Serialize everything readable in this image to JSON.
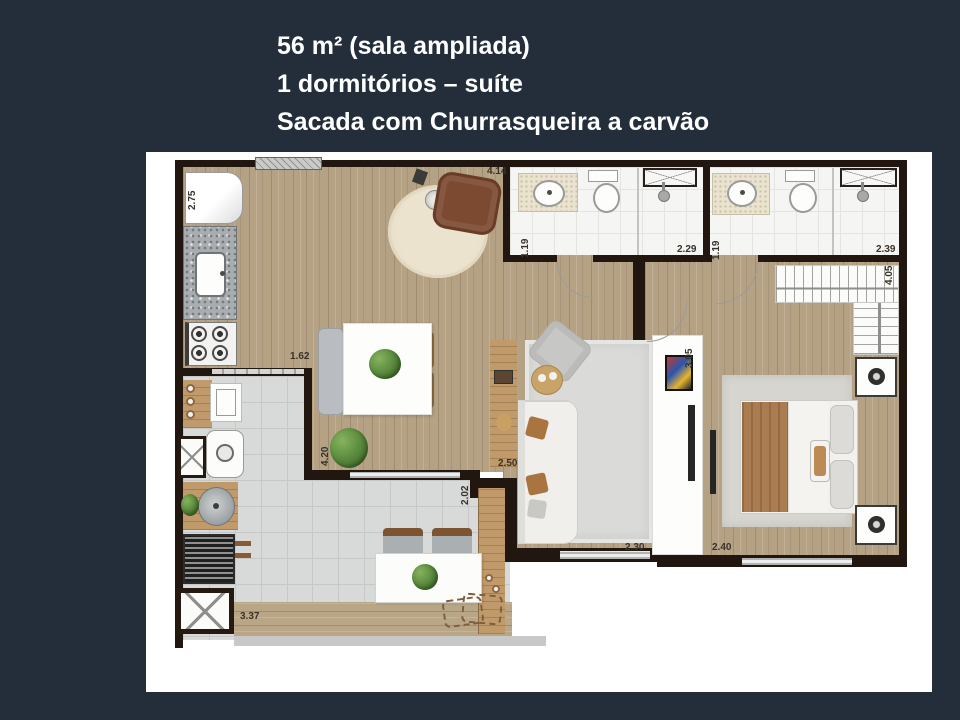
{
  "title": {
    "line1": "56 m² (sala ampliada)",
    "line2": "1 dormitórios – suíte",
    "line3": "Sacada com Churrasqueira a carvão"
  },
  "colors": {
    "background": "#242e3b",
    "card": "#ffffff",
    "wall": "#221710",
    "wood_floor": "#b5a285",
    "balcony_tile": "#d8dad9",
    "bath_tile": "#f5f5f3",
    "title_text": "#ffffff",
    "dimension_text": "#39322a"
  },
  "floorplan": {
    "dimensions": [
      {
        "id": "kitchen-depth",
        "label": "2.75",
        "orientation": "vertical"
      },
      {
        "id": "living-top",
        "label": "4.14",
        "orientation": "horizontal"
      },
      {
        "id": "bath1-depth",
        "label": "1.19",
        "orientation": "vertical"
      },
      {
        "id": "bath1-width",
        "label": "2.29",
        "orientation": "horizontal"
      },
      {
        "id": "bath2-depth",
        "label": "1.19",
        "orientation": "vertical"
      },
      {
        "id": "bath2-width",
        "label": "2.39",
        "orientation": "horizontal"
      },
      {
        "id": "bedroom-depth",
        "label": "4.05",
        "orientation": "vertical"
      },
      {
        "id": "living-depth",
        "label": "3.05",
        "orientation": "vertical"
      },
      {
        "id": "kitchen-opening",
        "label": "1.62",
        "orientation": "horizontal"
      },
      {
        "id": "balcony-depth",
        "label": "4.20",
        "orientation": "vertical"
      },
      {
        "id": "living-width",
        "label": "2.50",
        "orientation": "horizontal"
      },
      {
        "id": "balcony-pass",
        "label": "2.02",
        "orientation": "vertical"
      },
      {
        "id": "living-window",
        "label": "2.30",
        "orientation": "horizontal"
      },
      {
        "id": "bedroom-width",
        "label": "2.40",
        "orientation": "horizontal"
      },
      {
        "id": "balcony-width",
        "label": "3.37",
        "orientation": "horizontal"
      }
    ]
  }
}
